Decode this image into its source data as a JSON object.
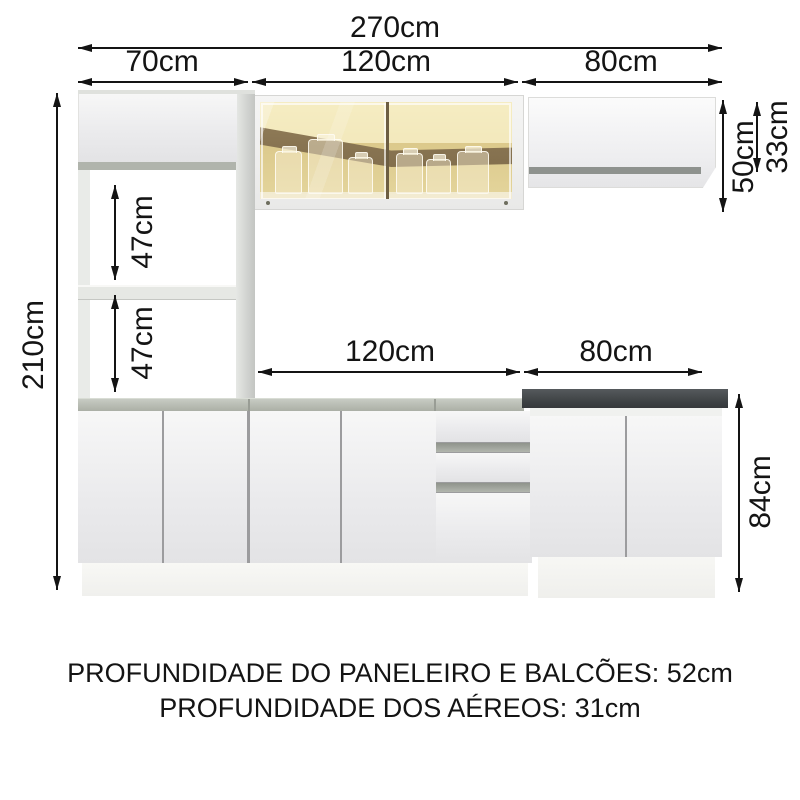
{
  "diagram": {
    "dims": {
      "total_width": "270cm",
      "pantry_width": "70cm",
      "upper_mid_width": "120cm",
      "upper_right_width": "80cm",
      "total_height": "210cm",
      "niche_upper_height": "47cm",
      "niche_lower_height": "47cm",
      "mid_cabinet_height": "50cm",
      "right_cabinet_height": "33cm",
      "base_mid_width": "120cm",
      "base_right_width": "80cm",
      "base_height": "84cm"
    },
    "footer": {
      "line1": "PROFUNDIDADE DO PANELEIRO E BALCÕES: 52cm",
      "line2": "PROFUNDIDADE DOS AÉREOS: 31cm"
    },
    "colors": {
      "dim_line": "#141414",
      "cabinet_white": "#efeff1",
      "countertop_light": "#b2b6ae",
      "countertop_dark": "#43474a",
      "glass_amber": "#ddc98e",
      "glass_shadow_brown": "#826d4c"
    }
  }
}
